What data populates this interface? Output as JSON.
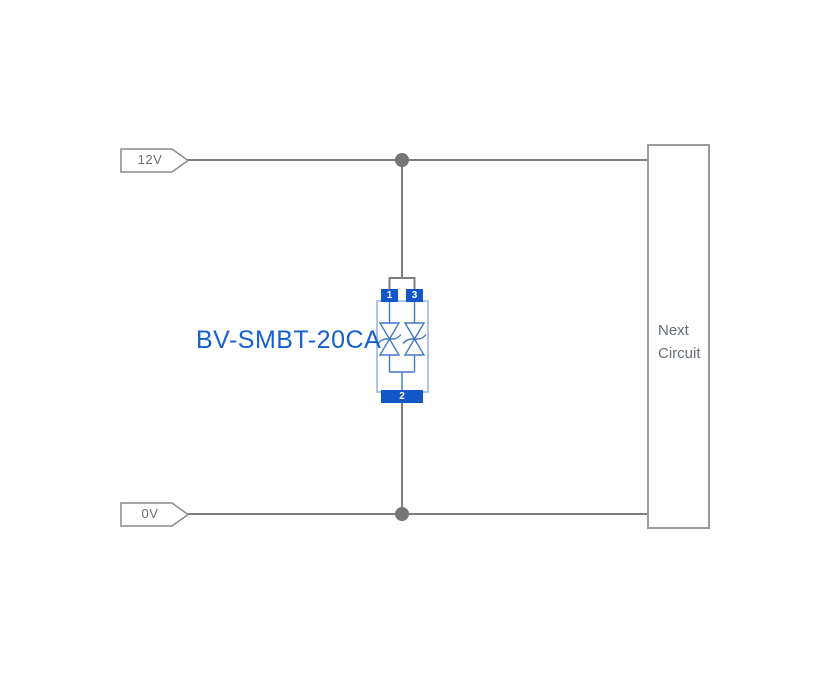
{
  "diagram": {
    "rails": {
      "top_label": "12V",
      "bottom_label": "0V"
    },
    "component": {
      "label": "BV-SMBT-20CA",
      "type": "bidirectional-tvs-diode-array",
      "pins": {
        "p1": "1",
        "p2": "2",
        "p3": "3"
      }
    },
    "next_circuit": {
      "line1": "Next",
      "line2": "Circuit"
    },
    "colors": {
      "wire_gray": "#7e7e7e",
      "junction_dot": "#757575",
      "flag_border": "#8a8a8a",
      "box_border": "#9b9b9b",
      "pad_blue": "#1257c5",
      "body_outline_blue": "#8fb3e0",
      "diode_blue": "#4377c2",
      "label_blue": "#1560cd",
      "text_gray": "#666d73"
    }
  }
}
